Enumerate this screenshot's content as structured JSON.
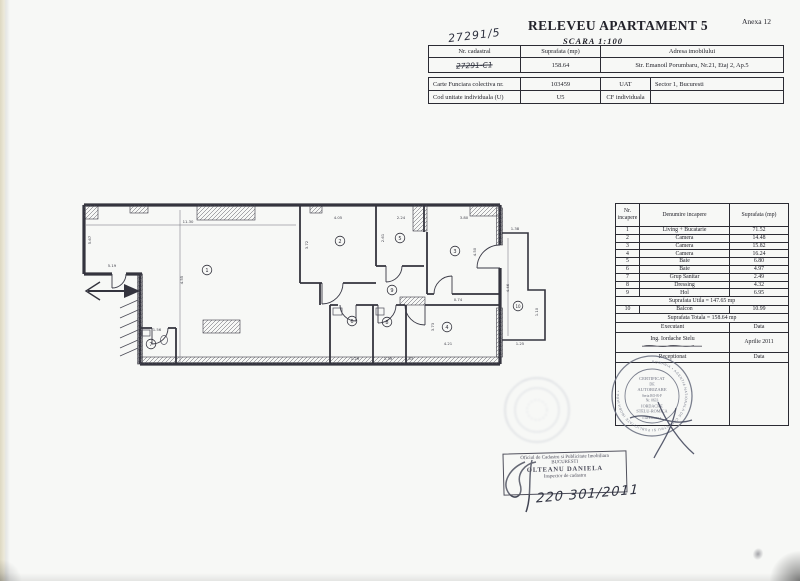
{
  "page": {
    "annex": "Anexa 12",
    "title": "RELEVEU APARTAMENT 5",
    "scale": "SCARA 1:100",
    "handwritten_number": "27291/5"
  },
  "cadastral_table": {
    "col_nr": "Nr. cadastral",
    "col_suprafata": "Suprafata (mp)",
    "col_adresa": "Adresa imobilului",
    "nr_value": "27291-C1",
    "suprafata_value": "158.64",
    "adresa_value": "Str. Emanoil Porumbaru, Nr.21, Etaj 2, Ap.5"
  },
  "cf_table": {
    "r1c1": "Carte Funciara colectiva nr.",
    "r1c2": "103459",
    "r1c3": "UAT",
    "r1c4": "Sector 1, Bucuresti",
    "r2c1": "Cod unitate individuala (U)",
    "r2c2": "U5",
    "r2c3": "CF individuala",
    "r2c4": ""
  },
  "rooms_table": {
    "h_nr": "Nr. incapere",
    "h_den": "Denumire incapere",
    "h_sup": "Suprafata (mp)",
    "rows": [
      [
        "1",
        "Living + Bucatarie",
        "71.52"
      ],
      [
        "2",
        "Camera",
        "14.48"
      ],
      [
        "3",
        "Camera",
        "15.82"
      ],
      [
        "4",
        "Camera",
        "16.24"
      ],
      [
        "5",
        "Baie",
        "6.80"
      ],
      [
        "6",
        "Baie",
        "4.97"
      ],
      [
        "7",
        "Grup Sanitar",
        "2.49"
      ],
      [
        "8",
        "Dressing",
        "4.32"
      ],
      [
        "9",
        "Hol",
        "6.95"
      ]
    ],
    "useful_area": "Suprafata Utila = 147.65 mp",
    "balcon": {
      "nr": "10",
      "name": "Balcon",
      "area": "10.99"
    },
    "total_area": "Suprafata Totala = 158.64 mp",
    "executant_label": "Executant",
    "data_label": "Data",
    "executant_name": "Ing. Iordache Stelu",
    "executant_date": "Aprilie 2011",
    "receptionat_label": "Receptionat",
    "receptionat_data_label": "Data"
  },
  "floor_plan": {
    "rooms": [
      {
        "n": "1",
        "x": 139,
        "y": 82
      },
      {
        "n": "2",
        "x": 272,
        "y": 53
      },
      {
        "n": "3",
        "x": 387,
        "y": 63
      },
      {
        "n": "4",
        "x": 379,
        "y": 139
      },
      {
        "n": "5",
        "x": 332,
        "y": 50
      },
      {
        "n": "6",
        "x": 284,
        "y": 133
      },
      {
        "n": "7",
        "x": 83,
        "y": 156
      },
      {
        "n": "8",
        "x": 319,
        "y": 134
      },
      {
        "n": "9",
        "x": 324,
        "y": 102
      },
      {
        "n": "10",
        "x": 450,
        "y": 118
      }
    ],
    "dimensions": [
      {
        "t": "11.30",
        "x": 120,
        "y": 35,
        "r": 0
      },
      {
        "t": "5.67",
        "x": 23,
        "y": 52,
        "r": -90
      },
      {
        "t": "5.19",
        "x": 44,
        "y": 79,
        "r": 0
      },
      {
        "t": "4.55",
        "x": 115,
        "y": 92,
        "r": -90
      },
      {
        "t": "4.05",
        "x": 270,
        "y": 31,
        "r": 0
      },
      {
        "t": "3.72",
        "x": 240,
        "y": 57,
        "r": -90
      },
      {
        "t": "2.24",
        "x": 333,
        "y": 31,
        "r": 0
      },
      {
        "t": "2.61",
        "x": 316,
        "y": 50,
        "r": -90
      },
      {
        "t": "3.80",
        "x": 396,
        "y": 31,
        "r": 0
      },
      {
        "t": "4.50",
        "x": 408,
        "y": 64,
        "r": -90
      },
      {
        "t": "0.74",
        "x": 390,
        "y": 113,
        "r": 0
      },
      {
        "t": "3.73",
        "x": 366,
        "y": 139,
        "r": -90
      },
      {
        "t": "4.21",
        "x": 380,
        "y": 157,
        "r": 0
      },
      {
        "t": "1.29",
        "x": 287,
        "y": 172,
        "r": 0
      },
      {
        "t": "1.39",
        "x": 320,
        "y": 172,
        "r": 0
      },
      {
        "t": "0.83",
        "x": 341,
        "y": 172,
        "r": 0
      },
      {
        "t": "1.56",
        "x": 89,
        "y": 143,
        "r": 0
      },
      {
        "t": "1.38",
        "x": 447,
        "y": 42,
        "r": 0
      },
      {
        "t": "4.46",
        "x": 441,
        "y": 100,
        "r": -90
      },
      {
        "t": "1.10",
        "x": 470,
        "y": 124,
        "r": -90
      },
      {
        "t": "1.25",
        "x": 452,
        "y": 157,
        "r": 0
      }
    ]
  },
  "stamps": {
    "certificate": {
      "l1": "CERTIFICAT",
      "l2": "DE",
      "l3": "AUTORIZARE",
      "serial": "Seria RO-B-F",
      "serial2": "Nr. 0633",
      "name1": "IORDACHE",
      "name2": "STELU-ROMICA",
      "category": "CATEGORIA",
      "ring": "ROMANIA • AGENTIA NATIONALA DE CADASTRU SI PUBLICITATE IMOBILIARA •"
    },
    "ocpi": {
      "line1": "Oficiul de Cadastru si Publicitate Imobiliara",
      "line2": "BUCURESTI",
      "name": "OLTEANU DANIELA",
      "role": "Inspector de cadastru",
      "handwritten_date": "220 301/2011"
    }
  }
}
